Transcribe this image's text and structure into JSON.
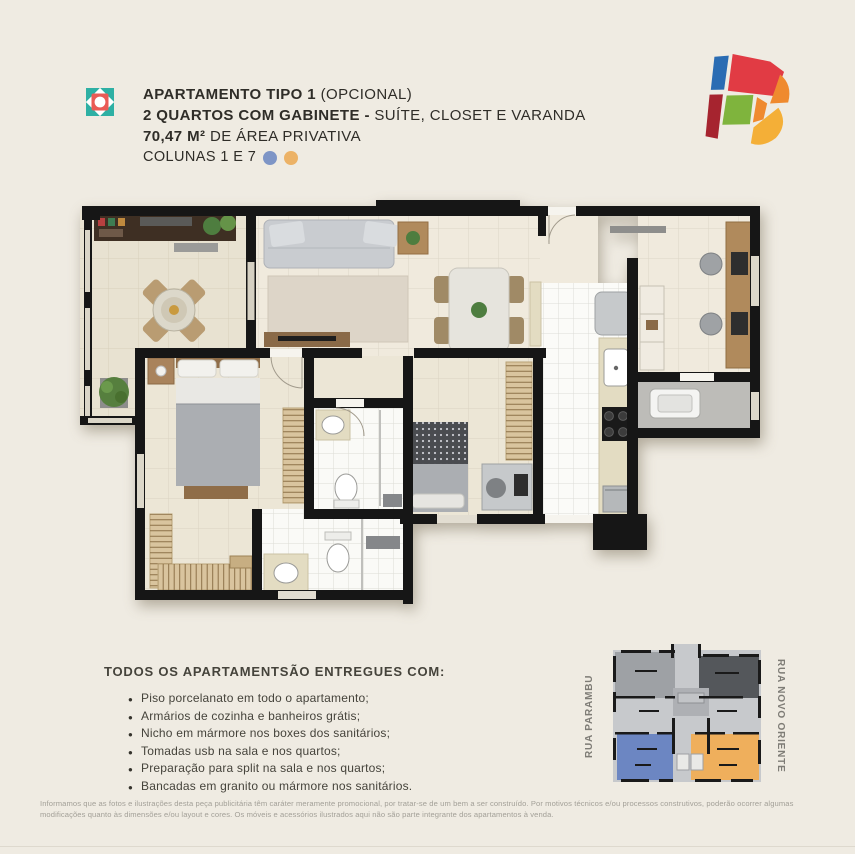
{
  "header": {
    "line1_bold": "APARTAMENTO TIPO 1",
    "line1_regular": " (OPCIONAL)",
    "line2_bold": "2 QUARTOS COM GABINETE - ",
    "line2_regular": "SUÍTE, CLOSET E VARANDA",
    "line3_bold": "70,47 M²",
    "line3_regular": " DE ÁREA PRIVATIVA",
    "line4": "COLUNAS 1 E 7",
    "column_dot_colors": {
      "column_1": "#7E95C6",
      "column_7": "#ECB266"
    },
    "icon_colors": {
      "square": "#2EB0A4",
      "flower": "#EA5A55"
    }
  },
  "brand_logo_colors": [
    "#2A6CB3",
    "#A6242F",
    "#E13B44",
    "#7FB43D",
    "#EF8A2F",
    "#F4AF37"
  ],
  "features": {
    "heading": "TODOS OS APARTAMENTSÃO ENTREGUES COM:",
    "items": [
      "Piso porcelanato em todo o apartamento;",
      "Armários de cozinha e banheiros grátis;",
      "Nicho em mármore nos boxes dos sanitários;",
      "Tomadas usb na sala e nos quartos;",
      "Preparação para split na sala e nos quartos;",
      "Bancadas em granito ou mármore nos sanitários."
    ]
  },
  "key_plan": {
    "street_left": "RUA PARAMBU",
    "street_right": "RUA NOVO ORIENTE",
    "unit_colors": {
      "column_1": "#6C86C2",
      "column_7": "#EFAF5C"
    }
  },
  "disclaimer": "Informamos que as fotos e ilustrações desta peça publicitária têm caráter meramente promocional, por tratar-se de um bem a ser construído. Por motivos técnicos e/ou processos construtivos, poderão ocorrer algumas modificações quanto às dimensões e/ou layout e cores. Os móveis e acessórios ilustrados aqui não são parte integrante dos apartamentos à venda."
}
